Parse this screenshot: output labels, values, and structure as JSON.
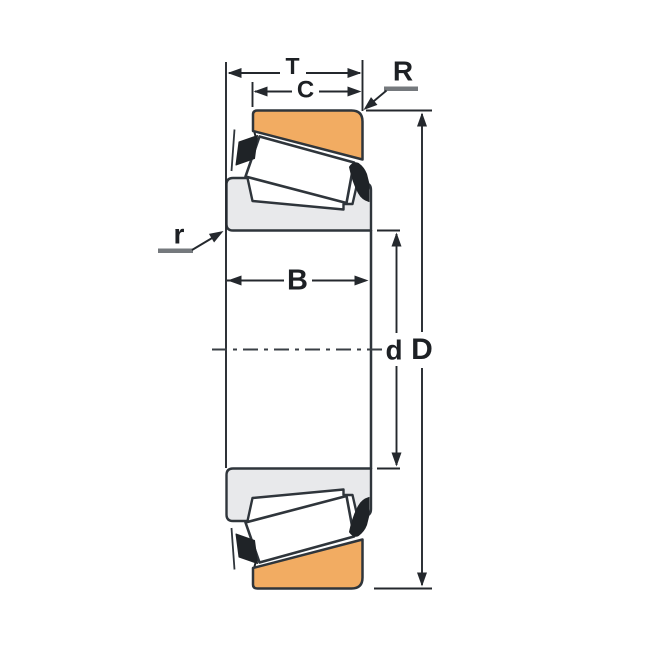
{
  "diagram": {
    "type": "technical-drawing",
    "subject": "tapered-roller-bearing-cross-section",
    "dimension_labels": {
      "T": "T",
      "C": "C",
      "R": "R",
      "r": "r",
      "B": "B",
      "d": "d",
      "D": "D"
    },
    "colors": {
      "background": "#ffffff",
      "cup_fill": "#f2ac62",
      "cone_fill": "#e8e9eb",
      "roller_fill": "#ffffff",
      "cage_fill": "#1f2327",
      "part_outline": "#2f353b",
      "dimension_lines": "#24282d",
      "leader_underline": "#75797d"
    }
  }
}
